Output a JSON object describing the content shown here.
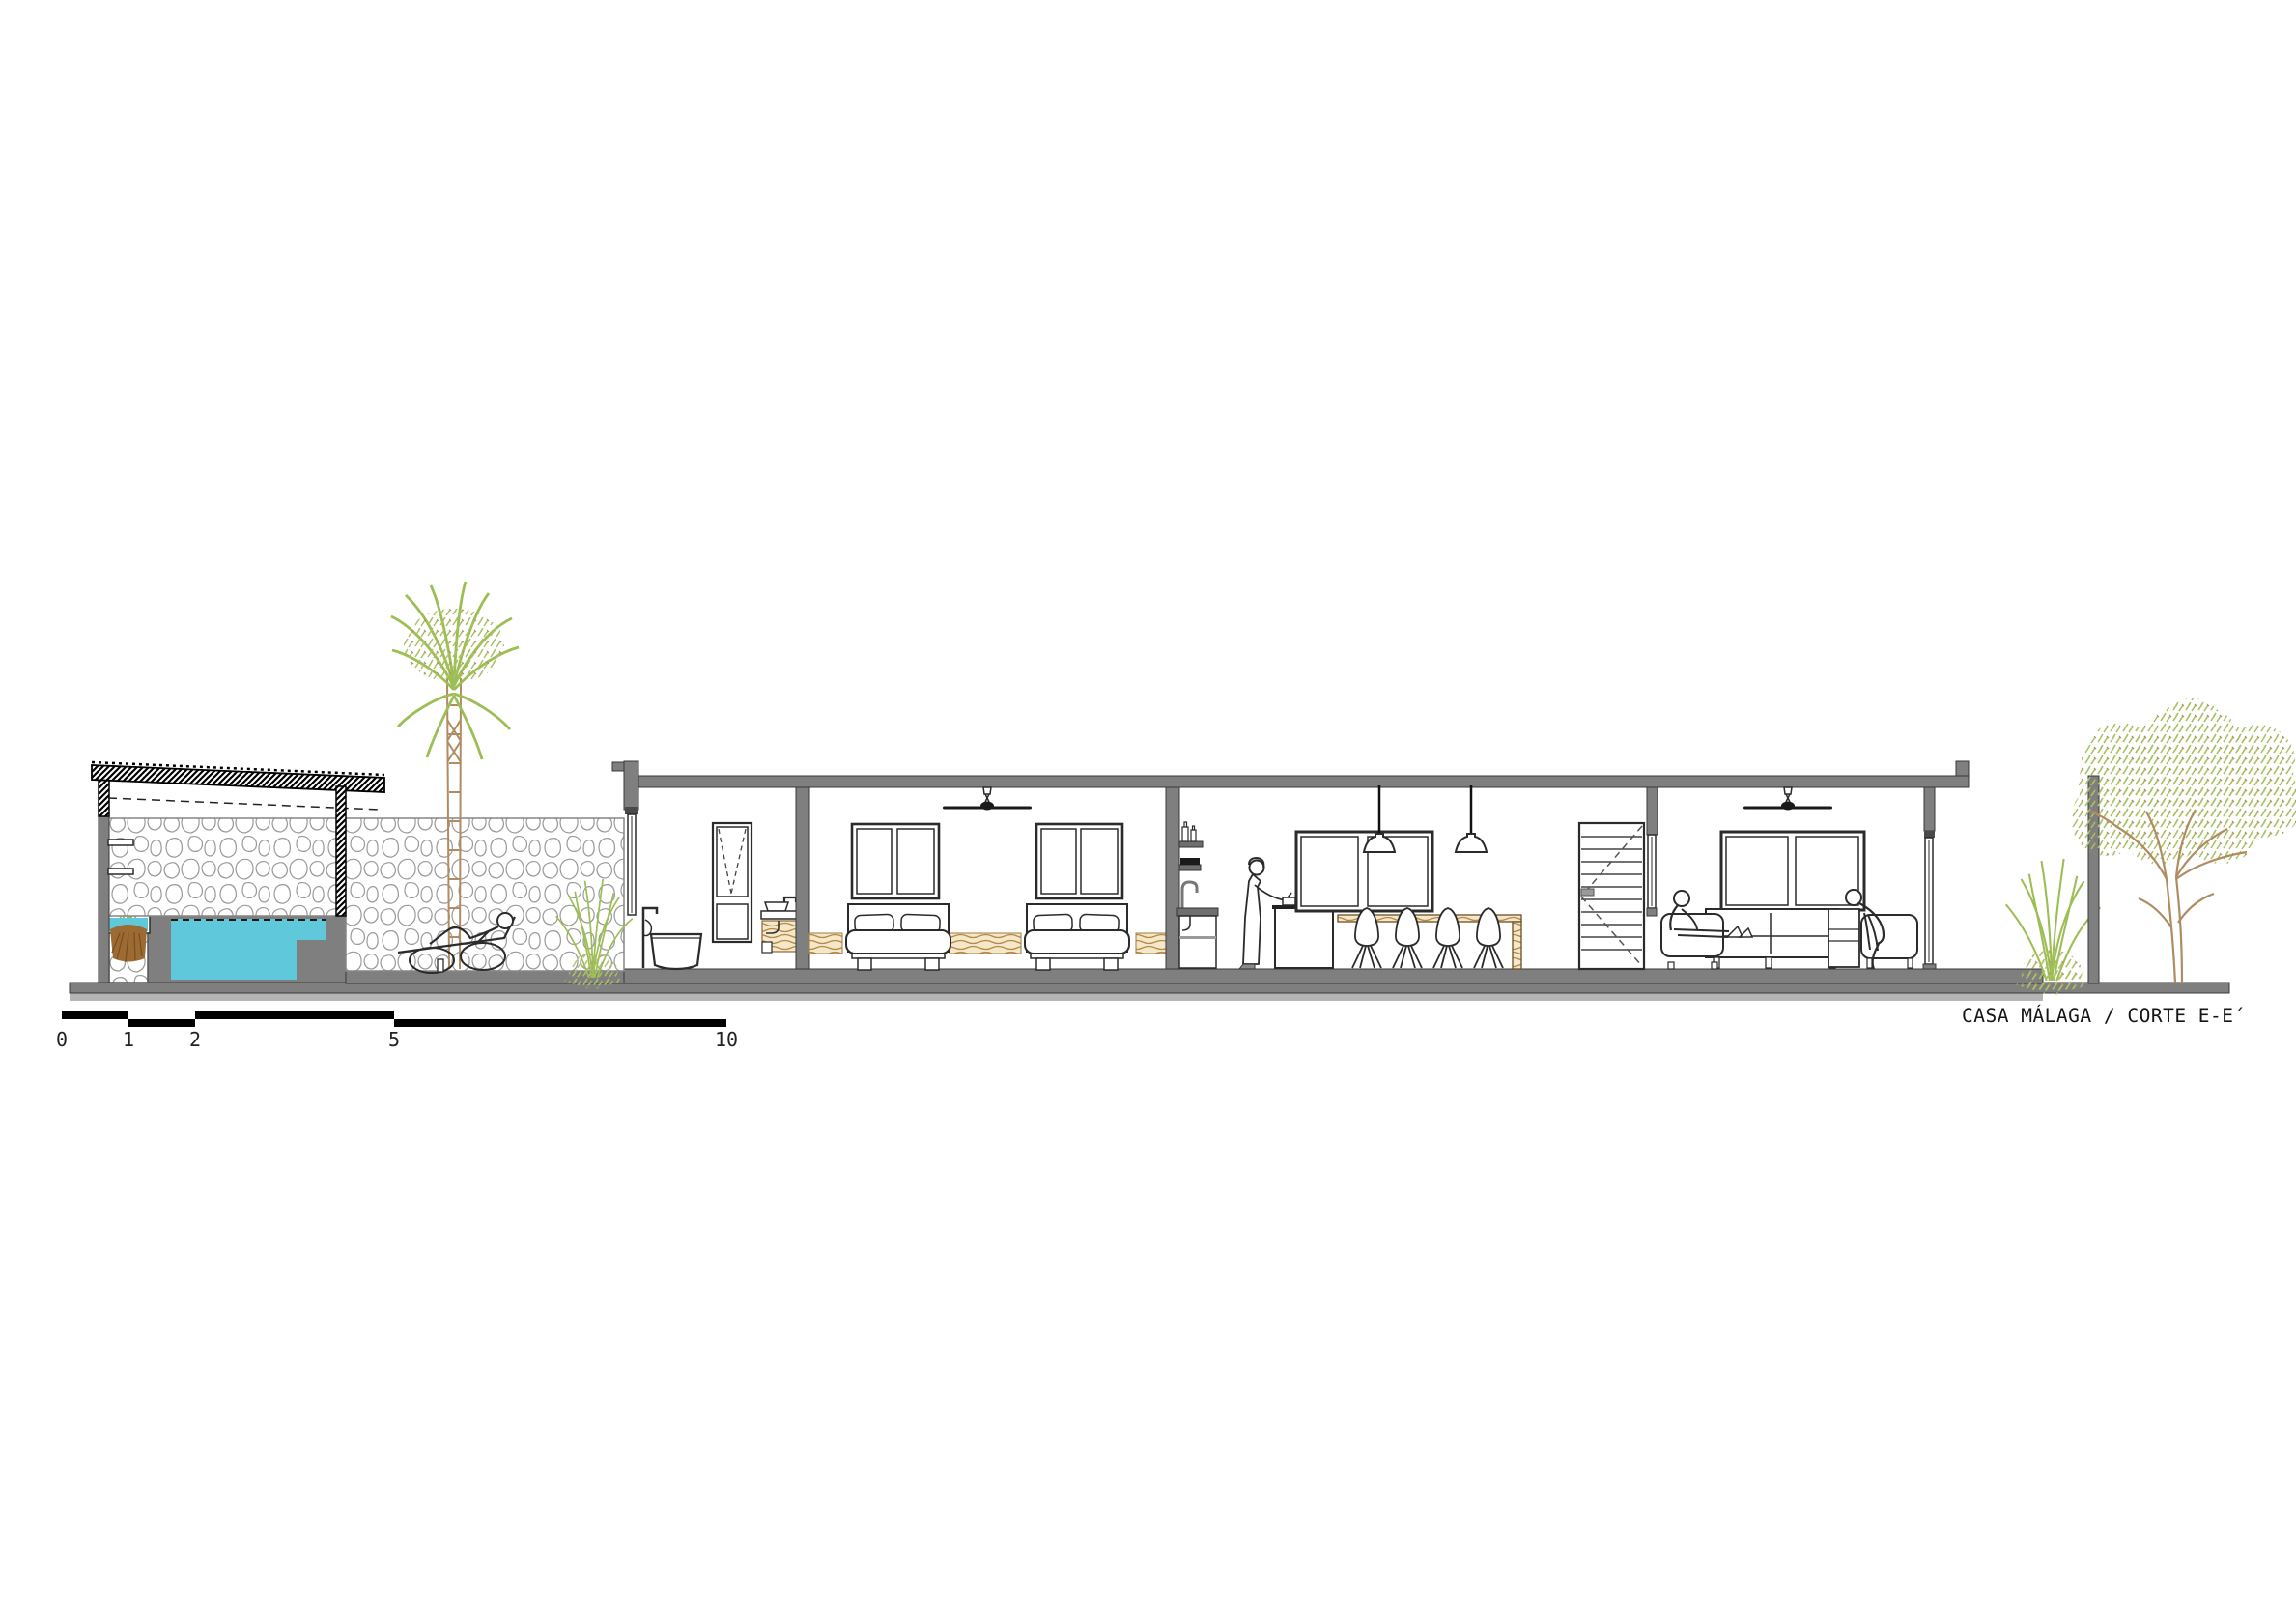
{
  "drawing": {
    "type": "architectural-section",
    "project": "CASA MÁLAGA",
    "view": "CORTE E-E´"
  },
  "title_block": {
    "label": "CASA MÁLAGA / CORTE E-E´"
  },
  "scale_bar": {
    "labels": [
      "0",
      "1",
      "2",
      "5",
      "10"
    ],
    "units": "meters"
  },
  "colors": {
    "wall": "#7f7f7f",
    "ground_light": "#b4b4b4",
    "pool": "#60C8DB",
    "wood": "#B5894A",
    "wood_bg": "#F4E8C8",
    "foliage": "#9DBE55",
    "tree_foliage": "#A9C064",
    "trunk": "#B08C62",
    "soil": "#9C6B33",
    "line": "#2b2b2b",
    "stone_outline": "#9a9a9a",
    "black": "#000000"
  },
  "elements": [
    "pergola",
    "planter",
    "swimming-pool",
    "stone-wall",
    "palm-tree",
    "lounge-chair",
    "person-lounging",
    "shrub",
    "bathroom-tub",
    "bathroom-window",
    "bathroom-sink",
    "bedroom-window",
    "bed",
    "ceiling-fan",
    "kitchen-shelves",
    "kitchen-sink",
    "person-cooking",
    "kitchen-island",
    "kitchen-window",
    "pendant-light",
    "bar-counter",
    "bar-stool",
    "louvered-door",
    "living-window",
    "sofa",
    "person-sitting",
    "garden-wall",
    "tree"
  ]
}
